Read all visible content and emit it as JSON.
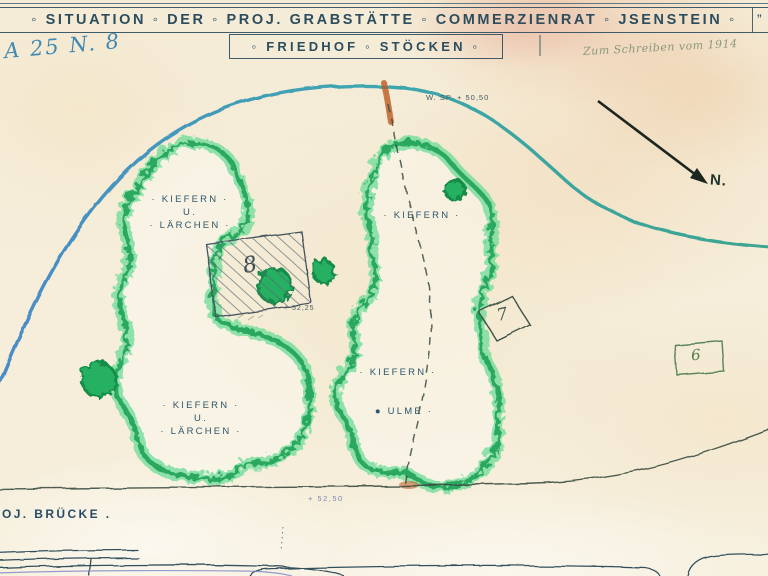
{
  "header": {
    "title": "◦ SITUATION ◦ DER ◦ PROJ. GRABSTÄTTE ◦ COMMERZIENRAT ◦ JSENSTEIN ◦",
    "title_end_mark": "”",
    "subtitle": "◦ FRIEDHOF ◦ STÖCKEN ◦",
    "archive_number": "A 25 N. 8",
    "handwritten_note": "Zum Schreiben vom 1914"
  },
  "map": {
    "north_label": "N.",
    "water_level": "W. SP. + 50,50",
    "elevation_plot8": "+ 52,25",
    "elevation_path": "+ 52,50",
    "bridge_label": "OJ. BRÜCKE .",
    "groves": {
      "northwest": {
        "line1": "· KIEFERN ·",
        "line2": "U.",
        "line3": "· LÄRCHEN ·"
      },
      "northeast": {
        "label": "· KIEFERN ·"
      },
      "middle": {
        "label": "· KIEFERN ·"
      },
      "elm": {
        "label": "● ULME ·"
      },
      "southwest": {
        "line1": "· KIEFERN ·",
        "line2": "U.",
        "line3": "· LÄRCHEN ·"
      }
    },
    "plots": {
      "plot6": "6",
      "plot7": "7",
      "plot8": "8"
    }
  },
  "legend_colors": {
    "ink_blue": "#2f566b",
    "grove_green": "#2abf6e",
    "road_blue_teal": "#3482b8",
    "path_orange": "#b95a20",
    "paper_cream": "#f5ecd7"
  }
}
